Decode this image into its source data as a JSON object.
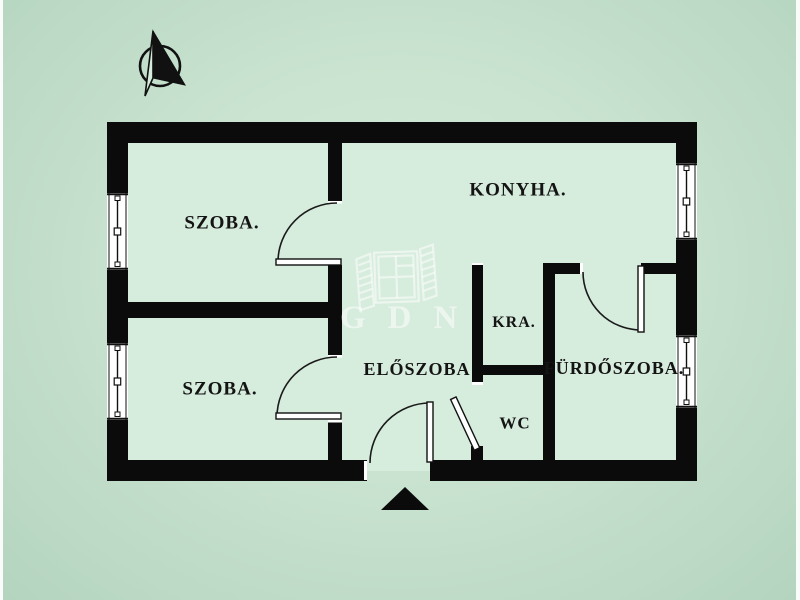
{
  "colors": {
    "background": "#c9e3d0",
    "interior": "#d5ebdb",
    "wall": "#0b0b0b",
    "watermark": "rgba(255,255,255,0.55)"
  },
  "compass": {
    "icon": "north-arrow-icon"
  },
  "watermark": {
    "logo_text": "GDN",
    "icon": "window-shutters-icon"
  },
  "rooms": [
    {
      "id": "szoba-upper",
      "label": "SZOBA."
    },
    {
      "id": "konyha",
      "label": "KONYHA."
    },
    {
      "id": "kamra",
      "label": "KRA."
    },
    {
      "id": "eloszoba",
      "label": "ELŐSZOBA"
    },
    {
      "id": "szoba-lower",
      "label": "SZOBA."
    },
    {
      "id": "wc",
      "label": "WC"
    },
    {
      "id": "furdoszoba",
      "label": "FÜRDŐSZOBA."
    }
  ],
  "entrance": {
    "marker": "entrance-triangle-icon"
  }
}
